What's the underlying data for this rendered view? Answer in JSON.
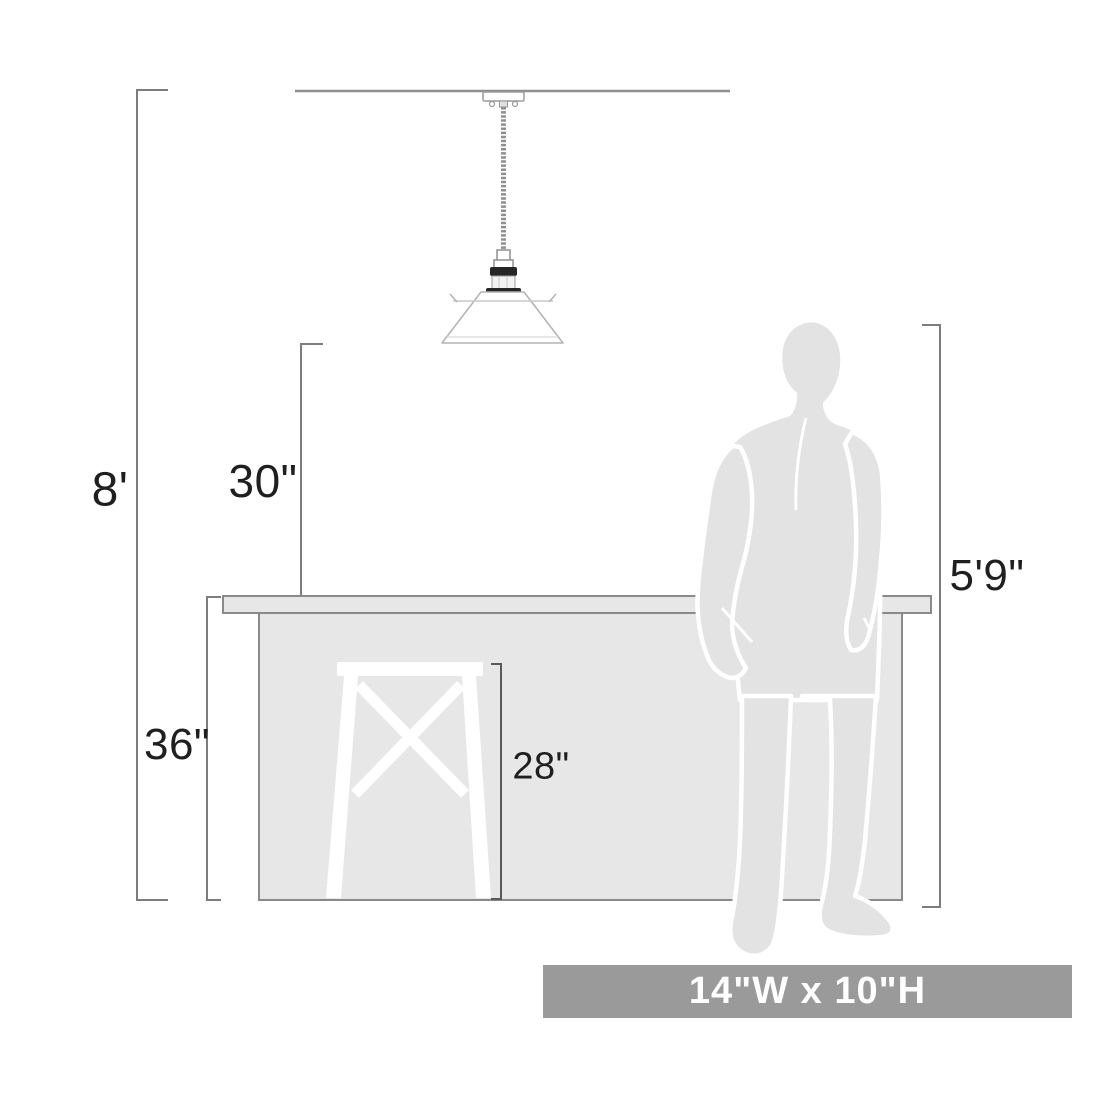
{
  "diagram": {
    "labels": {
      "ceiling_height": "8'",
      "hang_height": "30\"",
      "counter_height": "36\"",
      "stool_height": "28\"",
      "person_height": "5'9\"",
      "fixture_size": "14\"W x 10\"H"
    },
    "colors": {
      "background": "#ffffff",
      "dimension_line": "#7d7d7d",
      "drawing_outline": "#8a8a8a",
      "counter_fill": "#e7e7e7",
      "person_fill": "#e3e3e3",
      "stool_fill": "#ffffff",
      "socket_dark": "#262626",
      "banner_background": "#9a9a9a",
      "banner_text": "#ffffff",
      "label_text": "#1f1f1f"
    }
  }
}
